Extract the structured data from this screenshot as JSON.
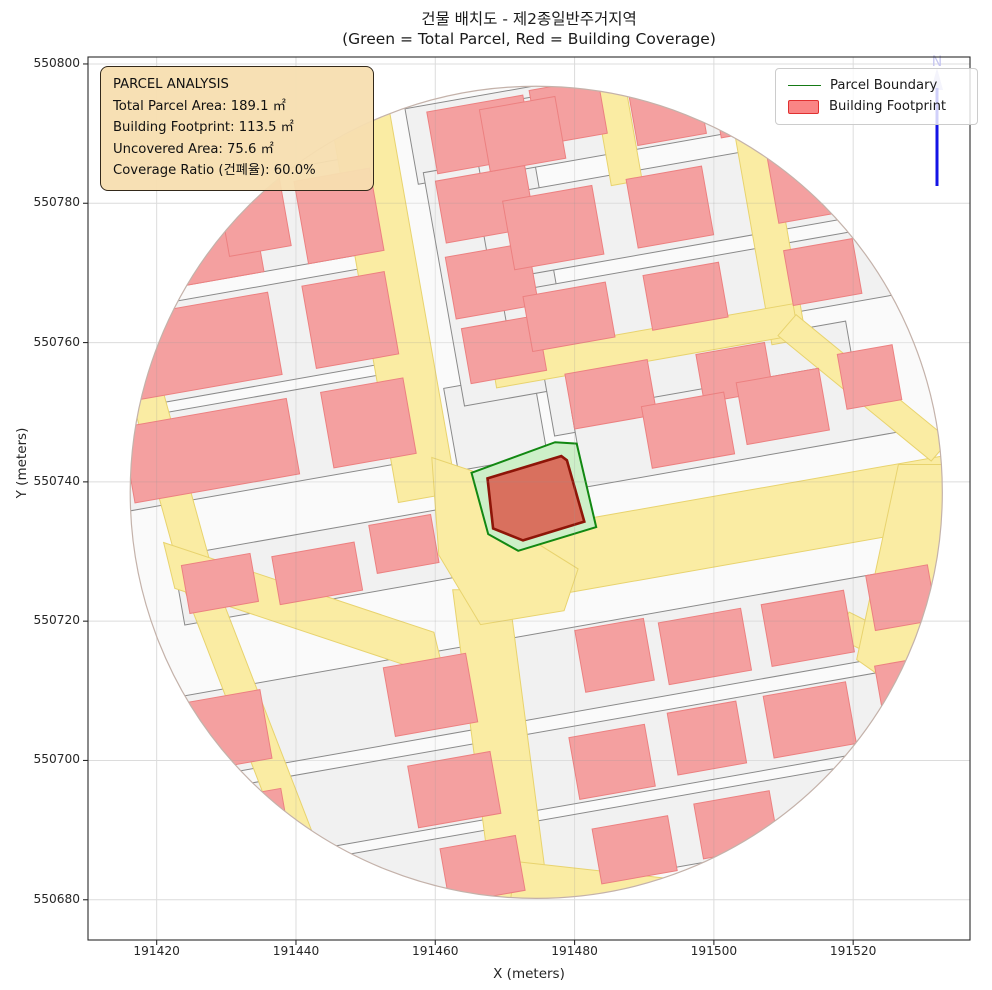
{
  "title": {
    "line1": "건물 배치도 - 제2종일반주거지역",
    "line2": "(Green = Total Parcel, Red = Building Coverage)"
  },
  "axes_labels": {
    "x": "X (meters)",
    "y": "Y (meters)"
  },
  "info_box": {
    "title": "PARCEL ANALYSIS",
    "line_total": "Total Parcel Area: 189.1 ㎡",
    "line_footprint": "Building Footprint: 113.5 ㎡",
    "line_uncovered": "Uncovered Area: 75.6 ㎡",
    "line_ratio": "Coverage Ratio (건폐율): 60.0%"
  },
  "legend": {
    "items": [
      {
        "label": "Parcel Boundary",
        "type": "line",
        "color": "#157a15"
      },
      {
        "label": "Building Footprint",
        "type": "patch",
        "fill": "#fa8585",
        "edge": "#e03030"
      }
    ]
  },
  "north_arrow": {
    "label": "N",
    "line_color": "#1414e6",
    "glyph_color": "#c6c6f0"
  },
  "stats": {
    "total_parcel_area_m2": 189.1,
    "building_footprint_m2": 113.5,
    "uncovered_area_m2": 75.6,
    "coverage_ratio_pct": 60.0
  },
  "chart_data": {
    "type": "map",
    "title": "건물 배치도 - 제2종일반주거지역",
    "subtitle": "(Green = Total Parcel, Red = Building Coverage)",
    "xlabel": "X (meters)",
    "ylabel": "Y (meters)",
    "x_ticks": [
      191420,
      191440,
      191460,
      191480,
      191500,
      191520
    ],
    "y_ticks": [
      550800,
      550780,
      550760,
      550740,
      550720,
      550700,
      550680
    ],
    "axes": {
      "x_at_left": 191410.14,
      "y_at_top": 550801.0,
      "px_per_m": 6.965
    },
    "plot": {
      "left": 88,
      "top": 57,
      "width": 882,
      "height": 883
    },
    "map": {
      "center": {
        "x": 191474.5,
        "y": 550738.5
      },
      "radius_m": 58.3,
      "grid_rotation_deg": 10,
      "colors": {
        "circle_fill": "#fafafa",
        "circle_edge": "#c4b2aa",
        "parcel_fill": "#f1f1f1",
        "parcel_edge": "#8a8a8a",
        "road_fill": "#faeca3",
        "road_edge": "#e8d36e",
        "building_fill": "#f4a0a0",
        "building_edge": "#ec8080",
        "subject_parcel_fill": "#cdefc8",
        "subject_parcel_edge": "#128812",
        "subject_building_fill": "#d9705e",
        "subject_building_edge": "#8e1508",
        "grid_color": "#dcdcdc",
        "grid_overlay": "rgba(150,150,150,0.22)",
        "spine": "#2b2b2b"
      },
      "parcels_grid_rects": [
        [
          -35,
          14,
          46,
          13
        ],
        [
          -35,
          29,
          46,
          14
        ],
        [
          -35,
          45,
          44,
          14
        ],
        [
          4,
          52,
          26,
          11
        ],
        [
          -4,
          11,
          13,
          12
        ],
        [
          0,
          31,
          16,
          34
        ],
        [
          -33,
          -5,
          40,
          10
        ],
        [
          26,
          12,
          44,
          9
        ],
        [
          30,
          5,
          46,
          11
        ],
        [
          28,
          24,
          56,
          10
        ],
        [
          28,
          37,
          58,
          12
        ],
        [
          26,
          51,
          52,
          10
        ],
        [
          0,
          -26,
          118,
          12
        ],
        [
          0,
          -39.5,
          118,
          11
        ],
        [
          -6,
          -51.5,
          104,
          10
        ]
      ],
      "roads_grid_rects": [
        [
          -15.5,
          32,
          8.5,
          60
        ],
        [
          39.5,
          33,
          5,
          36
        ],
        [
          20.5,
          50,
          4.5,
          17
        ],
        [
          19,
          18,
          44,
          4.5
        ],
        [
          30,
          -10,
          66,
          10
        ]
      ],
      "roads_polys": [
        [
          [
            -12,
            -14
          ],
          [
            -4,
            -14
          ],
          [
            2,
            -60
          ],
          [
            -6,
            -60
          ]
        ],
        [
          [
            -58.5,
            15
          ],
          [
            -50.5,
            -14
          ],
          [
            -33.5,
            -58
          ],
          [
            -29,
            -57
          ],
          [
            -46,
            -13
          ],
          [
            -54,
            16
          ]
        ],
        [
          [
            -53.5,
            -7.2
          ],
          [
            -14.7,
            -20.1
          ],
          [
            -13.1,
            -26.7
          ],
          [
            -51.9,
            -13.8
          ]
        ],
        [
          [
            34.7,
            22.5
          ],
          [
            56.7,
            4.5
          ],
          [
            59.3,
            7.5
          ],
          [
            37.3,
            25.5
          ]
        ],
        [
          [
            43.1,
            -20.8
          ],
          [
            61.1,
            -29.8
          ],
          [
            62.9,
            -26.2
          ],
          [
            44.9,
            -17.2
          ]
        ],
        [
          [
            52,
            4
          ],
          [
            63,
            4
          ],
          [
            63,
            -36
          ],
          [
            46,
            -24
          ]
        ],
        [
          [
            -15,
            5
          ],
          [
            -9,
            3
          ],
          [
            -2,
            -6
          ],
          [
            6,
            -11
          ],
          [
            4,
            -17
          ],
          [
            -8,
            -19
          ],
          [
            -14,
            -9
          ]
        ],
        [
          [
            -3,
            -53
          ],
          [
            24,
            -56
          ],
          [
            20,
            -61
          ],
          [
            -4,
            -61
          ]
        ]
      ],
      "buildings_grid_rects": [
        [
          -45,
          14,
          24,
          11
        ],
        [
          -22,
          14,
          12,
          11
        ],
        [
          -45,
          29,
          24,
          12
        ],
        [
          -22,
          29,
          12,
          12
        ],
        [
          -44,
          44,
          22,
          12
        ],
        [
          -21,
          44,
          11,
          12
        ],
        [
          -33,
          46,
          9,
          10
        ],
        [
          1,
          52,
          14,
          9
        ],
        [
          14,
          53,
          10,
          8
        ],
        [
          -47,
          -5,
          10,
          7
        ],
        [
          -33,
          -6,
          12,
          7
        ],
        [
          -20,
          -4,
          9,
          7
        ],
        [
          13,
          12,
          12,
          8
        ],
        [
          31,
          12,
          10,
          7
        ],
        [
          23,
          5,
          12,
          9
        ],
        [
          37,
          6,
          12,
          9
        ],
        [
          50,
          8,
          8,
          8
        ],
        [
          -1,
          21,
          11,
          8
        ],
        [
          -1,
          31,
          12,
          9
        ],
        [
          0,
          42,
          13,
          9
        ],
        [
          9,
          24,
          12,
          8
        ],
        [
          26,
          24,
          11,
          8
        ],
        [
          46,
          24,
          10,
          8
        ],
        [
          9,
          37,
          13,
          10
        ],
        [
          26,
          37,
          11,
          10
        ],
        [
          46,
          37,
          10,
          10
        ],
        [
          55,
          36,
          8,
          9
        ],
        [
          7,
          51,
          11,
          9
        ],
        [
          28,
          51,
          10,
          9
        ],
        [
          40,
          50,
          10,
          9
        ],
        [
          -50,
          -26,
          12,
          10
        ],
        [
          -20,
          -26,
          12,
          10
        ],
        [
          7,
          -25,
          10,
          9
        ],
        [
          20,
          -26,
          12,
          9
        ],
        [
          35,
          -26,
          12,
          9
        ],
        [
          49,
          -24,
          9,
          8
        ],
        [
          -49,
          -40,
          11,
          9
        ],
        [
          -19,
          -40,
          12,
          9
        ],
        [
          4,
          -40,
          11,
          9
        ],
        [
          18,
          -39,
          10,
          9
        ],
        [
          33,
          -39,
          12,
          9
        ],
        [
          48,
          -37,
          9,
          8
        ],
        [
          -40,
          -52,
          11,
          8
        ],
        [
          -17,
          -52,
          11,
          8
        ],
        [
          5,
          -53,
          11,
          8
        ],
        [
          20,
          -52,
          11,
          8
        ]
      ],
      "subject_parcel": [
        [
          -9.3,
          2.8
        ],
        [
          2.7,
          7.2
        ],
        [
          5.8,
          7.0
        ],
        [
          8.6,
          -5.0
        ],
        [
          -2.6,
          -8.4
        ],
        [
          -6.9,
          -6.0
        ]
      ],
      "subject_building": [
        [
          -7.0,
          2.0
        ],
        [
          3.6,
          5.2
        ],
        [
          4.4,
          4.6
        ],
        [
          6.9,
          -4.2
        ],
        [
          -1.9,
          -6.9
        ],
        [
          -6.2,
          -5.2
        ]
      ],
      "north_arrow_px": {
        "x": 937,
        "head_top": 66,
        "head_bottom": 90,
        "line_top": 88,
        "line_bottom": 186
      }
    }
  }
}
